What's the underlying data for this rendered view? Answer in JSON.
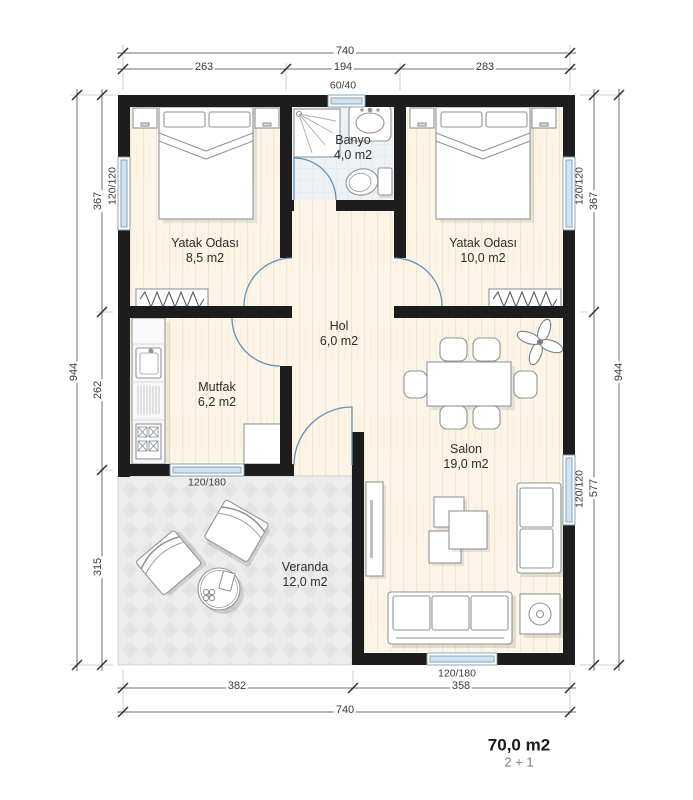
{
  "plan": {
    "summary": {
      "total_area": "70,0 m2",
      "room_count": "2 + 1"
    },
    "rooms": [
      {
        "name": "Yatak Odası",
        "area": "8,5 m2"
      },
      {
        "name": "Banyo",
        "area": "4,0 m2"
      },
      {
        "name": "Yatak Odası",
        "area": "10,0 m2"
      },
      {
        "name": "Hol",
        "area": "6,0 m2"
      },
      {
        "name": "Mutfak",
        "area": "6,2 m2"
      },
      {
        "name": "Salon",
        "area": "19,0 m2"
      },
      {
        "name": "Veranda",
        "area": "12,0 m2"
      }
    ],
    "windows": {
      "bath_top": "60/40",
      "bedroom_left": "120/120",
      "bedroom_right": "120/120",
      "salon_right": "120/120",
      "kitchen_bottom": "120/180",
      "salon_bottom": "120/180"
    },
    "dimensions": {
      "top": {
        "total": "740",
        "segments": [
          "263",
          "194",
          "283"
        ]
      },
      "bottom": {
        "total": "740",
        "segments": [
          "382",
          "358"
        ]
      },
      "left": {
        "total": "944",
        "segments": [
          "367",
          "262",
          "315"
        ]
      },
      "right": {
        "total": "944",
        "segments": [
          "367",
          "577"
        ]
      }
    },
    "colors": {
      "wall": "#1d1d1d",
      "door": "#5f93bd",
      "window_glass": "#cfe4f2",
      "window_frame": "#7f9db3",
      "floor_wood": "#fcf4e6",
      "floor_bath": "#eef2f5",
      "floor_veranda": "#ececec",
      "dimension_line": "#6e6e6e",
      "furniture_stroke": "#8f969b"
    }
  }
}
